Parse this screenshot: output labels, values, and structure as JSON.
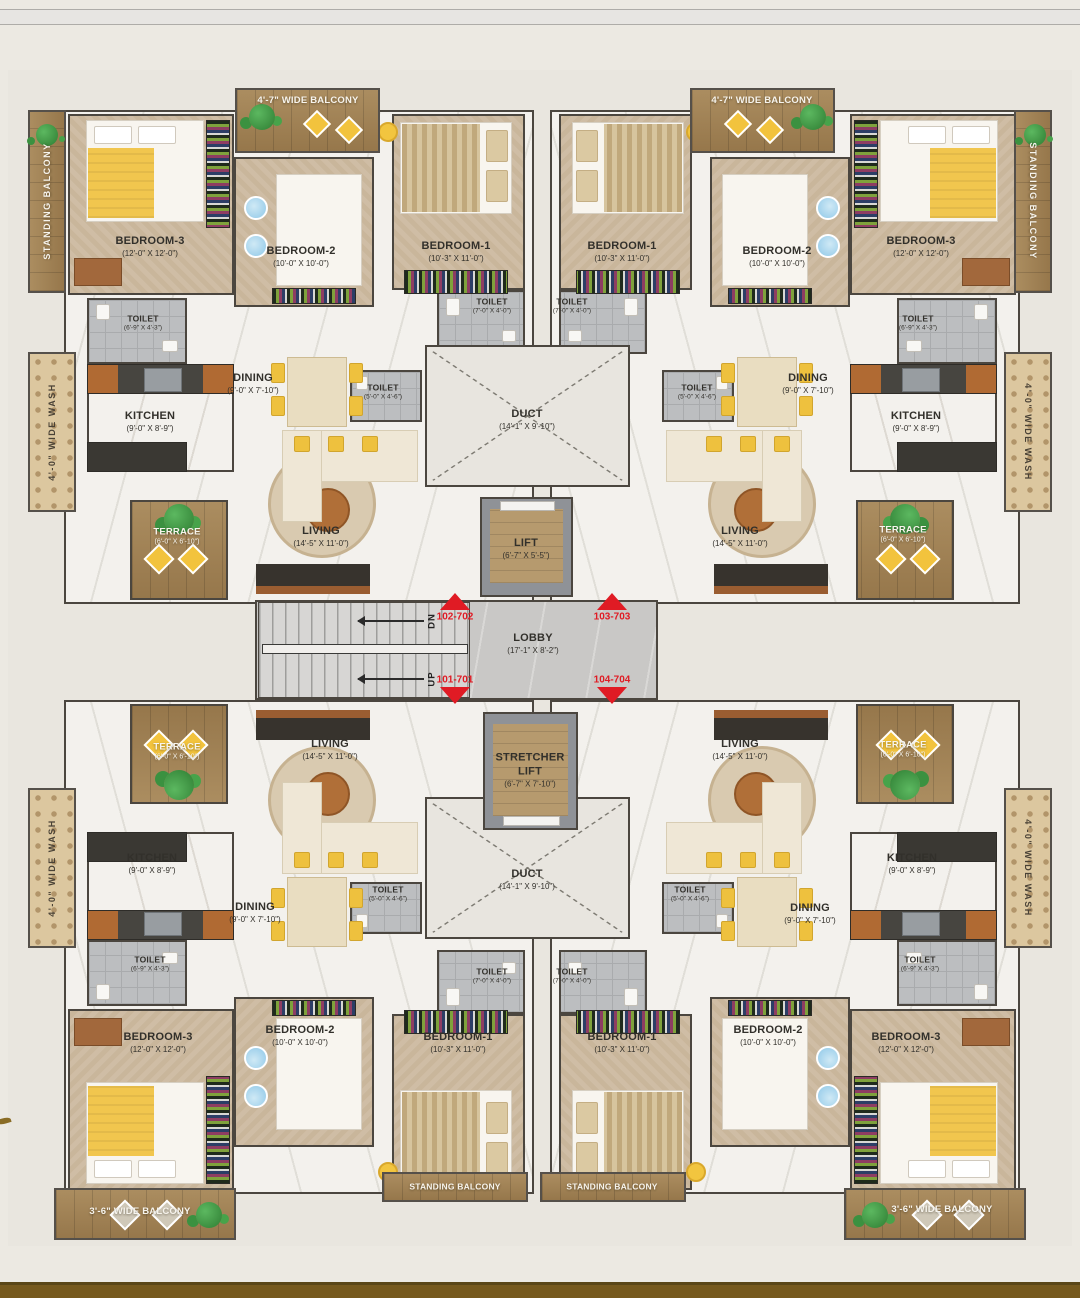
{
  "page": {
    "background": "#ece9e2",
    "top_band_color": "#e7e5e2",
    "bottom_band_color": "#76591d",
    "accent_red": "#e01b24",
    "wall_color": "#4b463f",
    "wood_color": "#a5865a"
  },
  "rooms": {
    "bedroom1": {
      "name": "BEDROOM-1",
      "dims": "(10'-3\" X 11'-0\")"
    },
    "bedroom2": {
      "name": "BEDROOM-2",
      "dims": "(10'-0\" X 10'-0\")"
    },
    "bedroom3": {
      "name": "BEDROOM-3",
      "dims": "(12'-0\" X 12'-0\")"
    },
    "kitchen": {
      "name": "KITCHEN",
      "dims": "(9'-0\" X 8'-9\")"
    },
    "dining": {
      "name": "DINING",
      "dims": "(9'-0\" X 7'-10\")"
    },
    "living": {
      "name": "LIVING",
      "dims": "(14'-5\" X 11'-0\")"
    },
    "toilet_a": {
      "name": "TOILET",
      "dims": "(7'-0\" X 4'-0\")"
    },
    "toilet_b": {
      "name": "TOILET",
      "dims": "(6'-9\" X 4'-3\")"
    },
    "toilet_c": {
      "name": "TOILET",
      "dims": "(5'-0\" X 4'-6\")"
    },
    "terrace": {
      "name": "TERRACE",
      "dims": "(6'-0\" X 6'-10\")"
    }
  },
  "core": {
    "duct": {
      "name": "DUCT",
      "dims": "(14'-1\" X 9'-10\")"
    },
    "lift": {
      "name": "LIFT",
      "dims": "(6'-7\" X 5'-5\")"
    },
    "stretcher_lift": {
      "name1": "STRETCHER",
      "name2": "LIFT",
      "dims": "(6'-7\" X 7'-10\")"
    },
    "lobby": {
      "name": "LOBBY",
      "dims": "(17'-1\" X 8'-2\")"
    },
    "stairs": {
      "down": "DN",
      "up": "UP"
    }
  },
  "balconies": {
    "wide_47": "4'-7\" WIDE BALCONY",
    "wide_36": "3'-6\" WIDE BALCONY",
    "standing": "STANDING BALCONY",
    "wash": "4'-0\" WIDE WASH"
  },
  "unit_markers": [
    {
      "id": "102-702",
      "direction": "up"
    },
    {
      "id": "103-703",
      "direction": "up"
    },
    {
      "id": "101-701",
      "direction": "down"
    },
    {
      "id": "104-704",
      "direction": "down"
    }
  ]
}
